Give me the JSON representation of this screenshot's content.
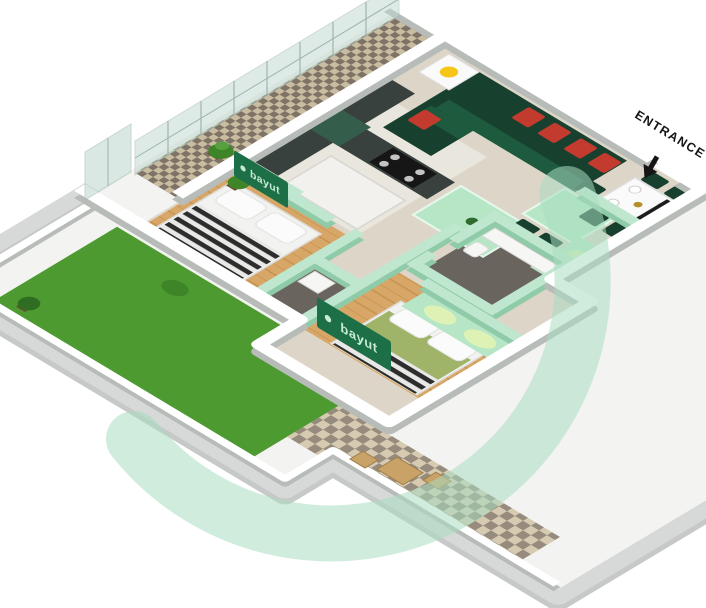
{
  "labels": {
    "entrance": "ENTRANCE"
  },
  "watermark": {
    "brand": "bayut"
  },
  "colors": {
    "bg": "#ffffff",
    "boundary_gray": "#c6c9c7",
    "boundary_top": "#d6d9d7",
    "wall_white": "#ffffff",
    "wall_shadow": "#b8bcb9",
    "wall_mint": "#bfe7cf",
    "wall_mint_shadow": "#8fcaa9",
    "floor_beige": "#ddd6c8",
    "floor_kitchen": "#e9e6de",
    "yard_concrete": "#f3f3f1",
    "wood": "#d8a767",
    "wood_line": "#c2914e",
    "bath_floor": "#6a645f",
    "lawn": "#4d9a31",
    "balcony_check_light": "#c8bca1",
    "balcony_check_dark": "#7f7366",
    "patio_check_light": "#d6cbb1",
    "patio_check_dark": "#968b7d",
    "sofa": "#17402e",
    "sofa_seat": "#1d5a3e",
    "cushion": "#c23b2e",
    "mint_furniture": "#b7e6c6",
    "table_white": "#fafafa",
    "chair_dark": "#17402e",
    "lamp": "#f5c518",
    "counter_dark": "#39413e",
    "hood_green": "#355d4b",
    "stove": "#161616",
    "burner": "#c4c4c4",
    "island": "#f2f1ee",
    "wardrobe_glow": "#e9f5ad",
    "bed_green": "#9fb469",
    "plant": "#3e8527",
    "pot": "#6b4a32",
    "glass": "#bcd7cd",
    "glass_frame": "#9fb4ac",
    "ring": "#a9ddc1",
    "banner": "#1c6f47",
    "banner_text": "#c9ead7",
    "text_dark": "#151515",
    "tan": "#c9a268"
  }
}
